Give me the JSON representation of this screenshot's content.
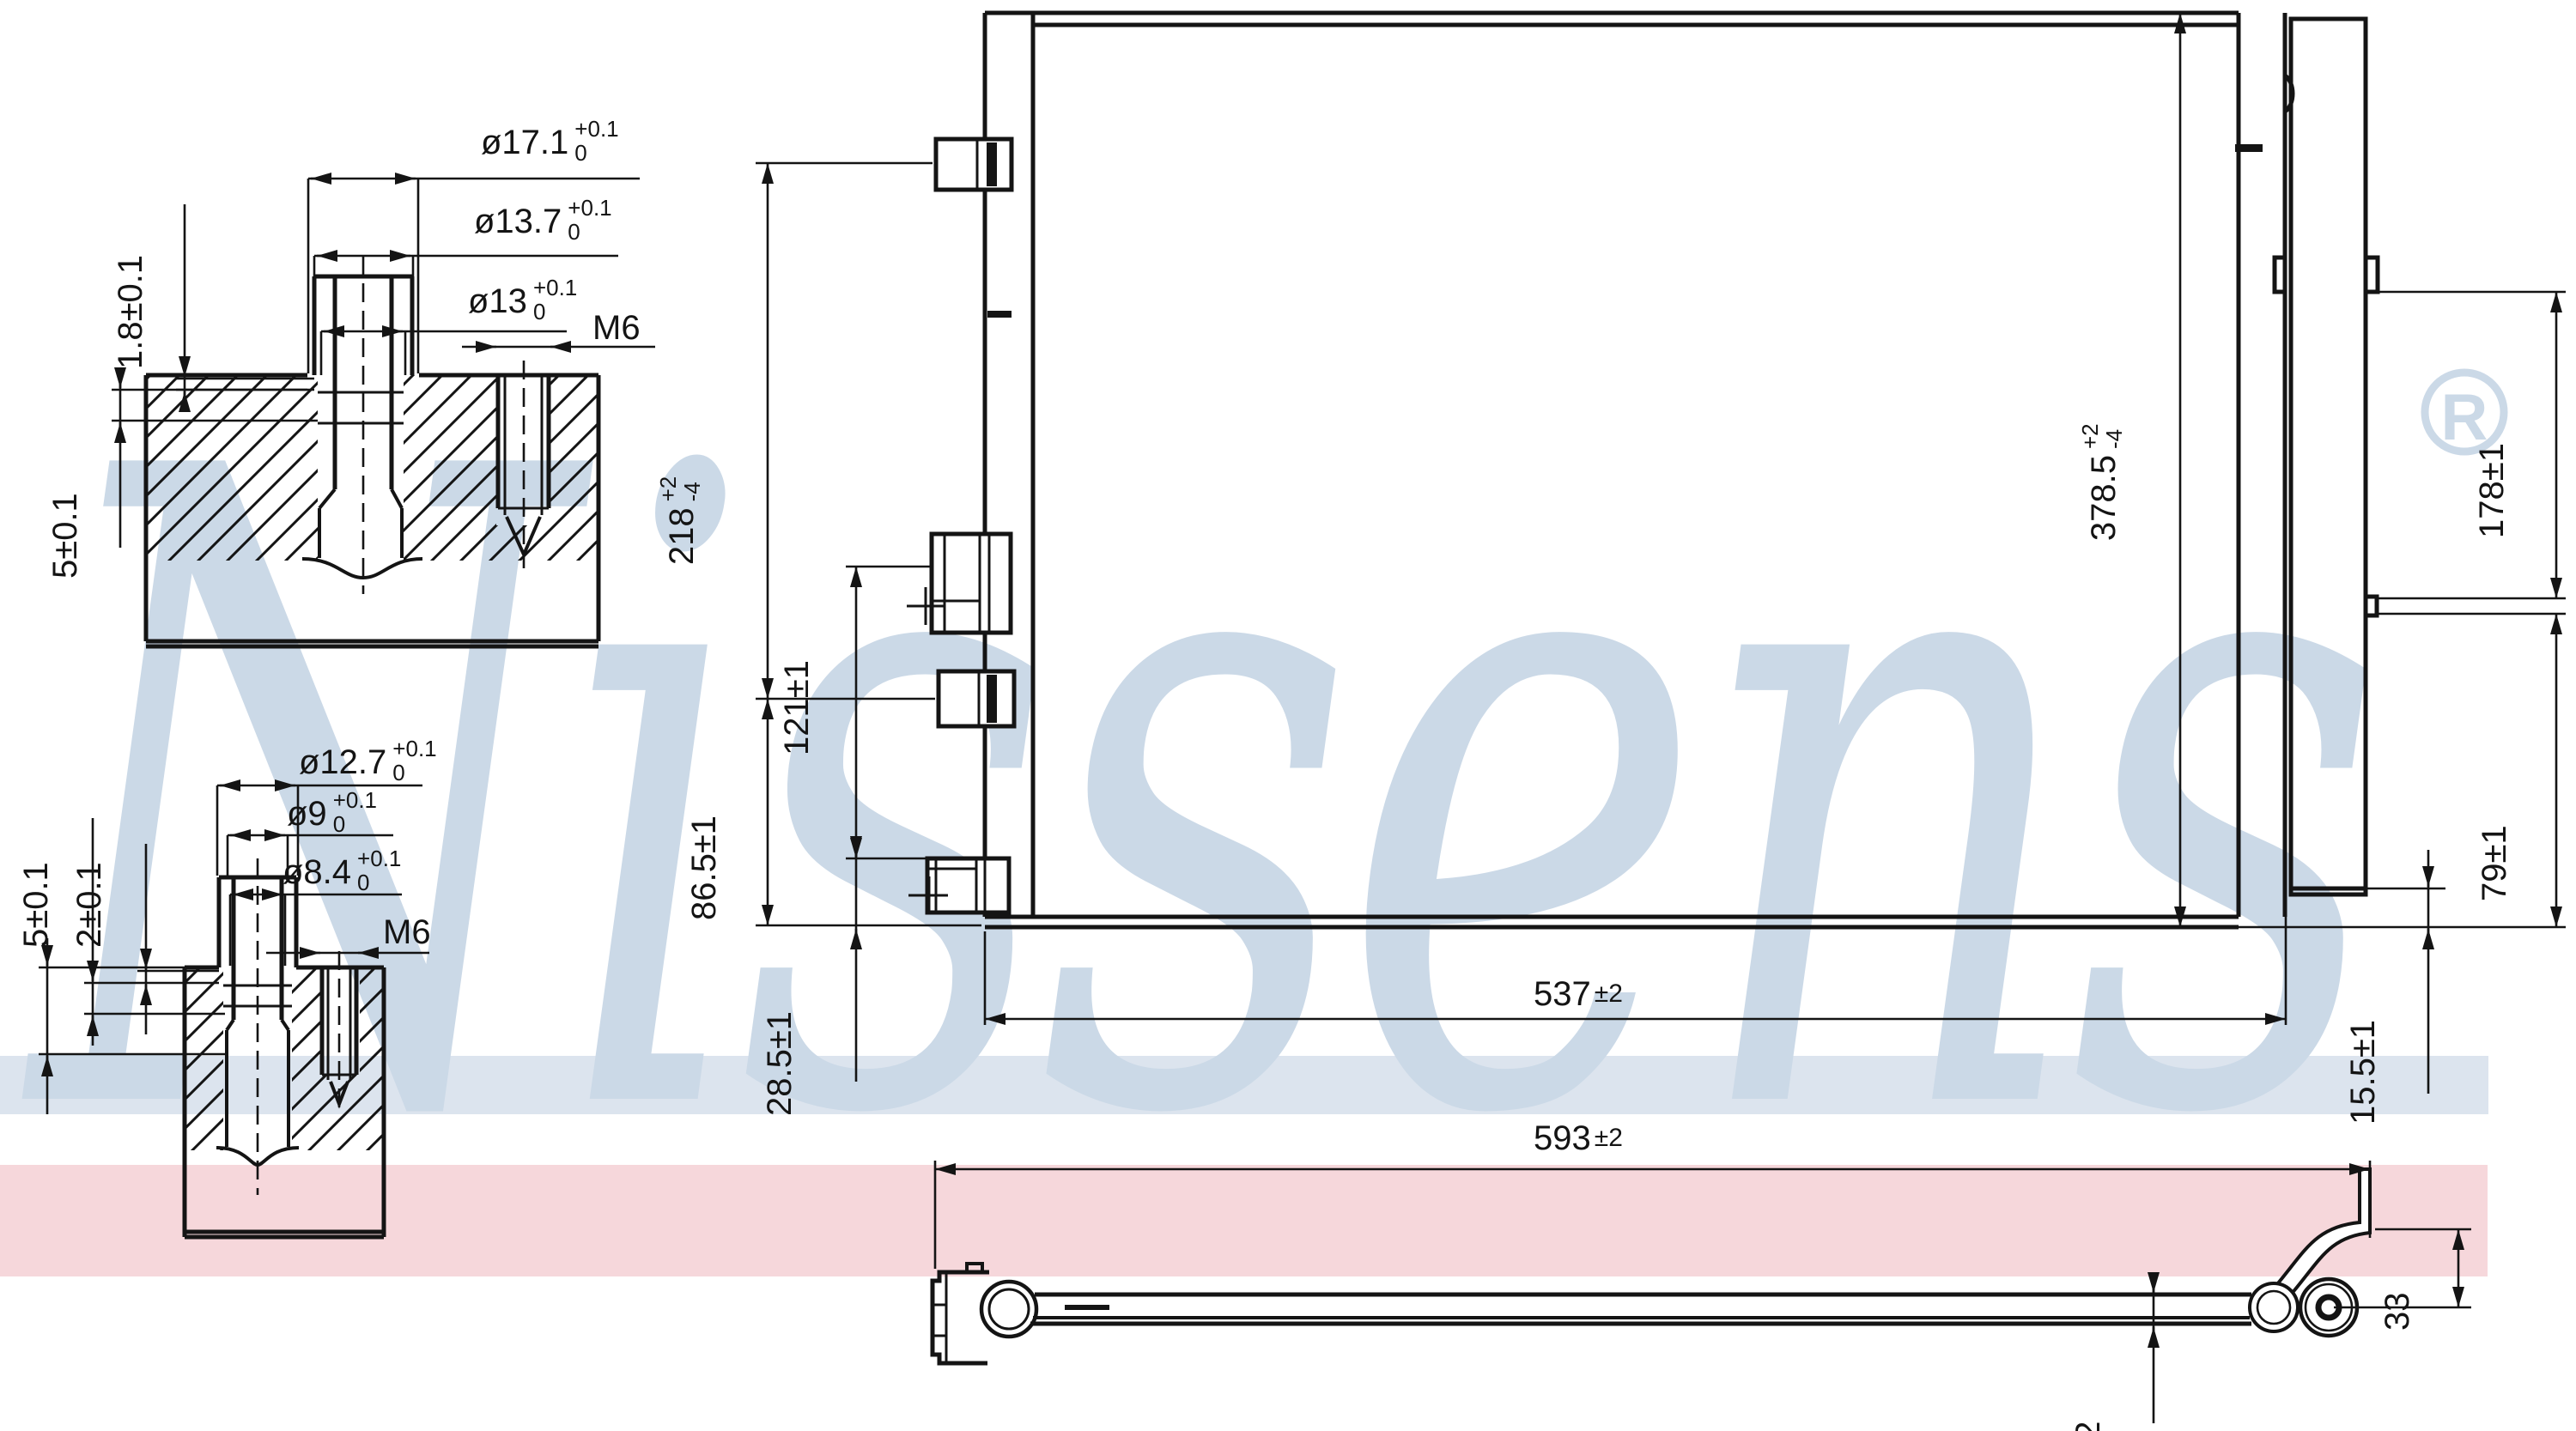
{
  "watermark": {
    "text": "Nissens",
    "registered": "R",
    "color": "#cbd9e7"
  },
  "bands": {
    "blue": "#dce4ee",
    "pink": "#f6d7db"
  },
  "detail_top": {
    "dia1": {
      "value": "ø17.1",
      "tol_plus": "+0.1",
      "tol_minus": "0"
    },
    "dia2": {
      "value": "ø13.7",
      "tol_plus": "+0.1",
      "tol_minus": "0"
    },
    "dia3": {
      "value": "ø13",
      "tol_plus": "+0.1",
      "tol_minus": "0"
    },
    "thread": "M6",
    "flange_thickness": "1.8±0.1",
    "depth": "5±0.1"
  },
  "detail_bottom": {
    "dia1": {
      "value": "ø12.7",
      "tol_plus": "+0.1",
      "tol_minus": "0"
    },
    "dia2": {
      "value": "ø9",
      "tol_plus": "+0.1",
      "tol_minus": "0"
    },
    "dia3": {
      "value": "ø8.4",
      "tol_plus": "+0.1",
      "tol_minus": "0"
    },
    "thread": "M6",
    "depth5": "5±0.1",
    "depth2": "2±0.1",
    "depth14": {
      "value": "14",
      "tol_plus": "+0.1",
      "tol_minus": "0"
    }
  },
  "front_view": {
    "height_left": {
      "value": "218",
      "tol_plus": "+2",
      "tol_minus": "-4"
    },
    "port_spacing": "121±1",
    "port_height": "86.5±1",
    "port_bottom": "28.5±1",
    "width": {
      "value": "537",
      "tol": "±2"
    },
    "height_right": {
      "value": "378.5",
      "tol_plus": "+2",
      "tol_minus": "-4"
    },
    "drier_upper": "178±1",
    "drier_lower": "79±1",
    "bottom_offset": "15.5±1"
  },
  "bottom_view": {
    "width": {
      "value": "593",
      "tol": "±2"
    },
    "bracket_height": "33",
    "tube_height": "12"
  }
}
